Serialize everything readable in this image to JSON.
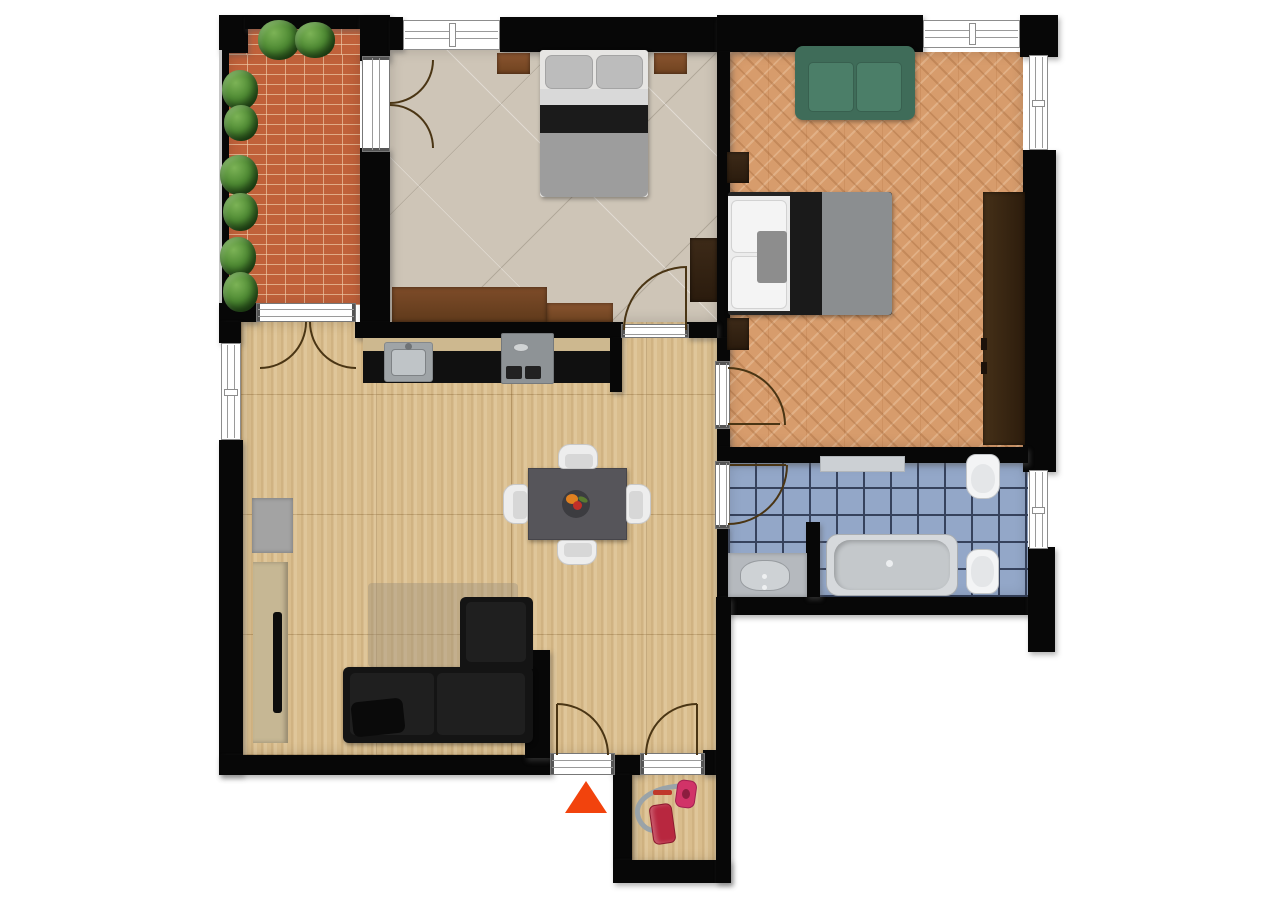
{
  "scene": {
    "kind": "apartment floor plan, top-down 2D render",
    "background": "#ffffff",
    "wall_color": "#070707",
    "door_arc_color": "#4a3514"
  },
  "entrance_marker": {
    "shape": "triangle-up",
    "color": "#f2430d"
  },
  "rooms": [
    {
      "name": "balcony",
      "floor_material": "brick-pavers",
      "floor_color": "#c0613a",
      "items": [
        "plants x8",
        "railing"
      ]
    },
    {
      "name": "bedroom-1",
      "floor_material": "beige-ceramic-tile",
      "floor_color": "#cec5b7",
      "items": [
        "double-bed",
        "nightstand-left",
        "nightstand-right",
        "long-dresser",
        "wardrobe"
      ]
    },
    {
      "name": "bedroom-2",
      "floor_material": "herringbone-parquet",
      "floor_color": "#d79c6c",
      "items": [
        "green-sofa",
        "double-bed",
        "nightstand-top",
        "nightstand-bottom",
        "tall-wardrobe"
      ]
    },
    {
      "name": "living-kitchen",
      "floor_material": "travertine",
      "floor_color": "#d9bd8d",
      "items": [
        "kitchen-counter",
        "kitchen-sink",
        "stove",
        "dining-table",
        "chairs x4",
        "fruit-bowl",
        "black-corner-sofa",
        "throw-pillow",
        "rug",
        "tv-sideboard",
        "tv",
        "gray-cabinet"
      ]
    },
    {
      "name": "bathroom",
      "floor_material": "blue-mosaic-tile",
      "floor_color": "#93a7c8",
      "items": [
        "shelf",
        "toilet",
        "bathtub",
        "bidet",
        "washbasin-counter"
      ]
    },
    {
      "name": "entry-storage",
      "floor_material": "travertine",
      "floor_color": "#d9bd8d",
      "items": [
        "vacuum-cleaner"
      ]
    }
  ],
  "palette": {
    "sofa_black": "#161616",
    "sofa_green": "#44705c",
    "dining_table_gray": "#56555a",
    "wood_brown": "#7b4a28",
    "wardrobe_dark": "#362515",
    "fixture_white": "#f3f4f5",
    "tub_gray": "#c9cdd0",
    "counter_black": "#101010",
    "vacuum_red": "#c42a45",
    "vacuum_pink": "#d13368"
  }
}
